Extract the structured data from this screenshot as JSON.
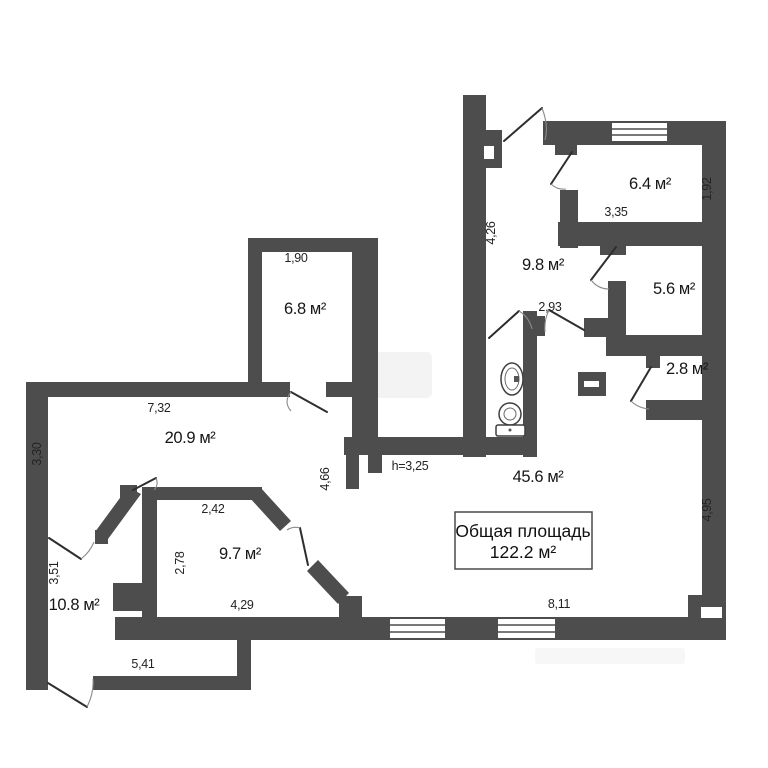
{
  "plan": {
    "background": "#ffffff",
    "wall_color": "#4d4d4d",
    "total_area_box": {
      "line1": "Общая площадь",
      "line2": "122.2 м²"
    },
    "rooms": [
      {
        "id": "room-6-8",
        "label": "6.8 м²"
      },
      {
        "id": "room-9-8",
        "label": "9.8 м²"
      },
      {
        "id": "room-6-4",
        "label": "6.4 м²"
      },
      {
        "id": "room-5-6",
        "label": "5.6 м²"
      },
      {
        "id": "room-2-8",
        "label": "2.8 м²"
      },
      {
        "id": "room-20-9",
        "label": "20.9 м²"
      },
      {
        "id": "room-45-6",
        "label": "45.6 м²"
      },
      {
        "id": "room-9-7",
        "label": "9.7 м²"
      },
      {
        "id": "room-10-8",
        "label": "10.8 м²"
      }
    ],
    "dimensions": [
      {
        "text": "1,90"
      },
      {
        "text": "4,26"
      },
      {
        "text": "2,93"
      },
      {
        "text": "3,35"
      },
      {
        "text": "1,92"
      },
      {
        "text": "7,32"
      },
      {
        "text": "3,30"
      },
      {
        "text": "4,66"
      },
      {
        "text": "h=3,25"
      },
      {
        "text": "2,42"
      },
      {
        "text": "2,78"
      },
      {
        "text": "4,29"
      },
      {
        "text": "3,51"
      },
      {
        "text": "5,41"
      },
      {
        "text": "8,11"
      },
      {
        "text": "4,95"
      }
    ],
    "fixtures": [
      {
        "name": "sink-icon"
      },
      {
        "name": "toilet-icon"
      },
      {
        "name": "vent-shaft-icon"
      }
    ]
  }
}
